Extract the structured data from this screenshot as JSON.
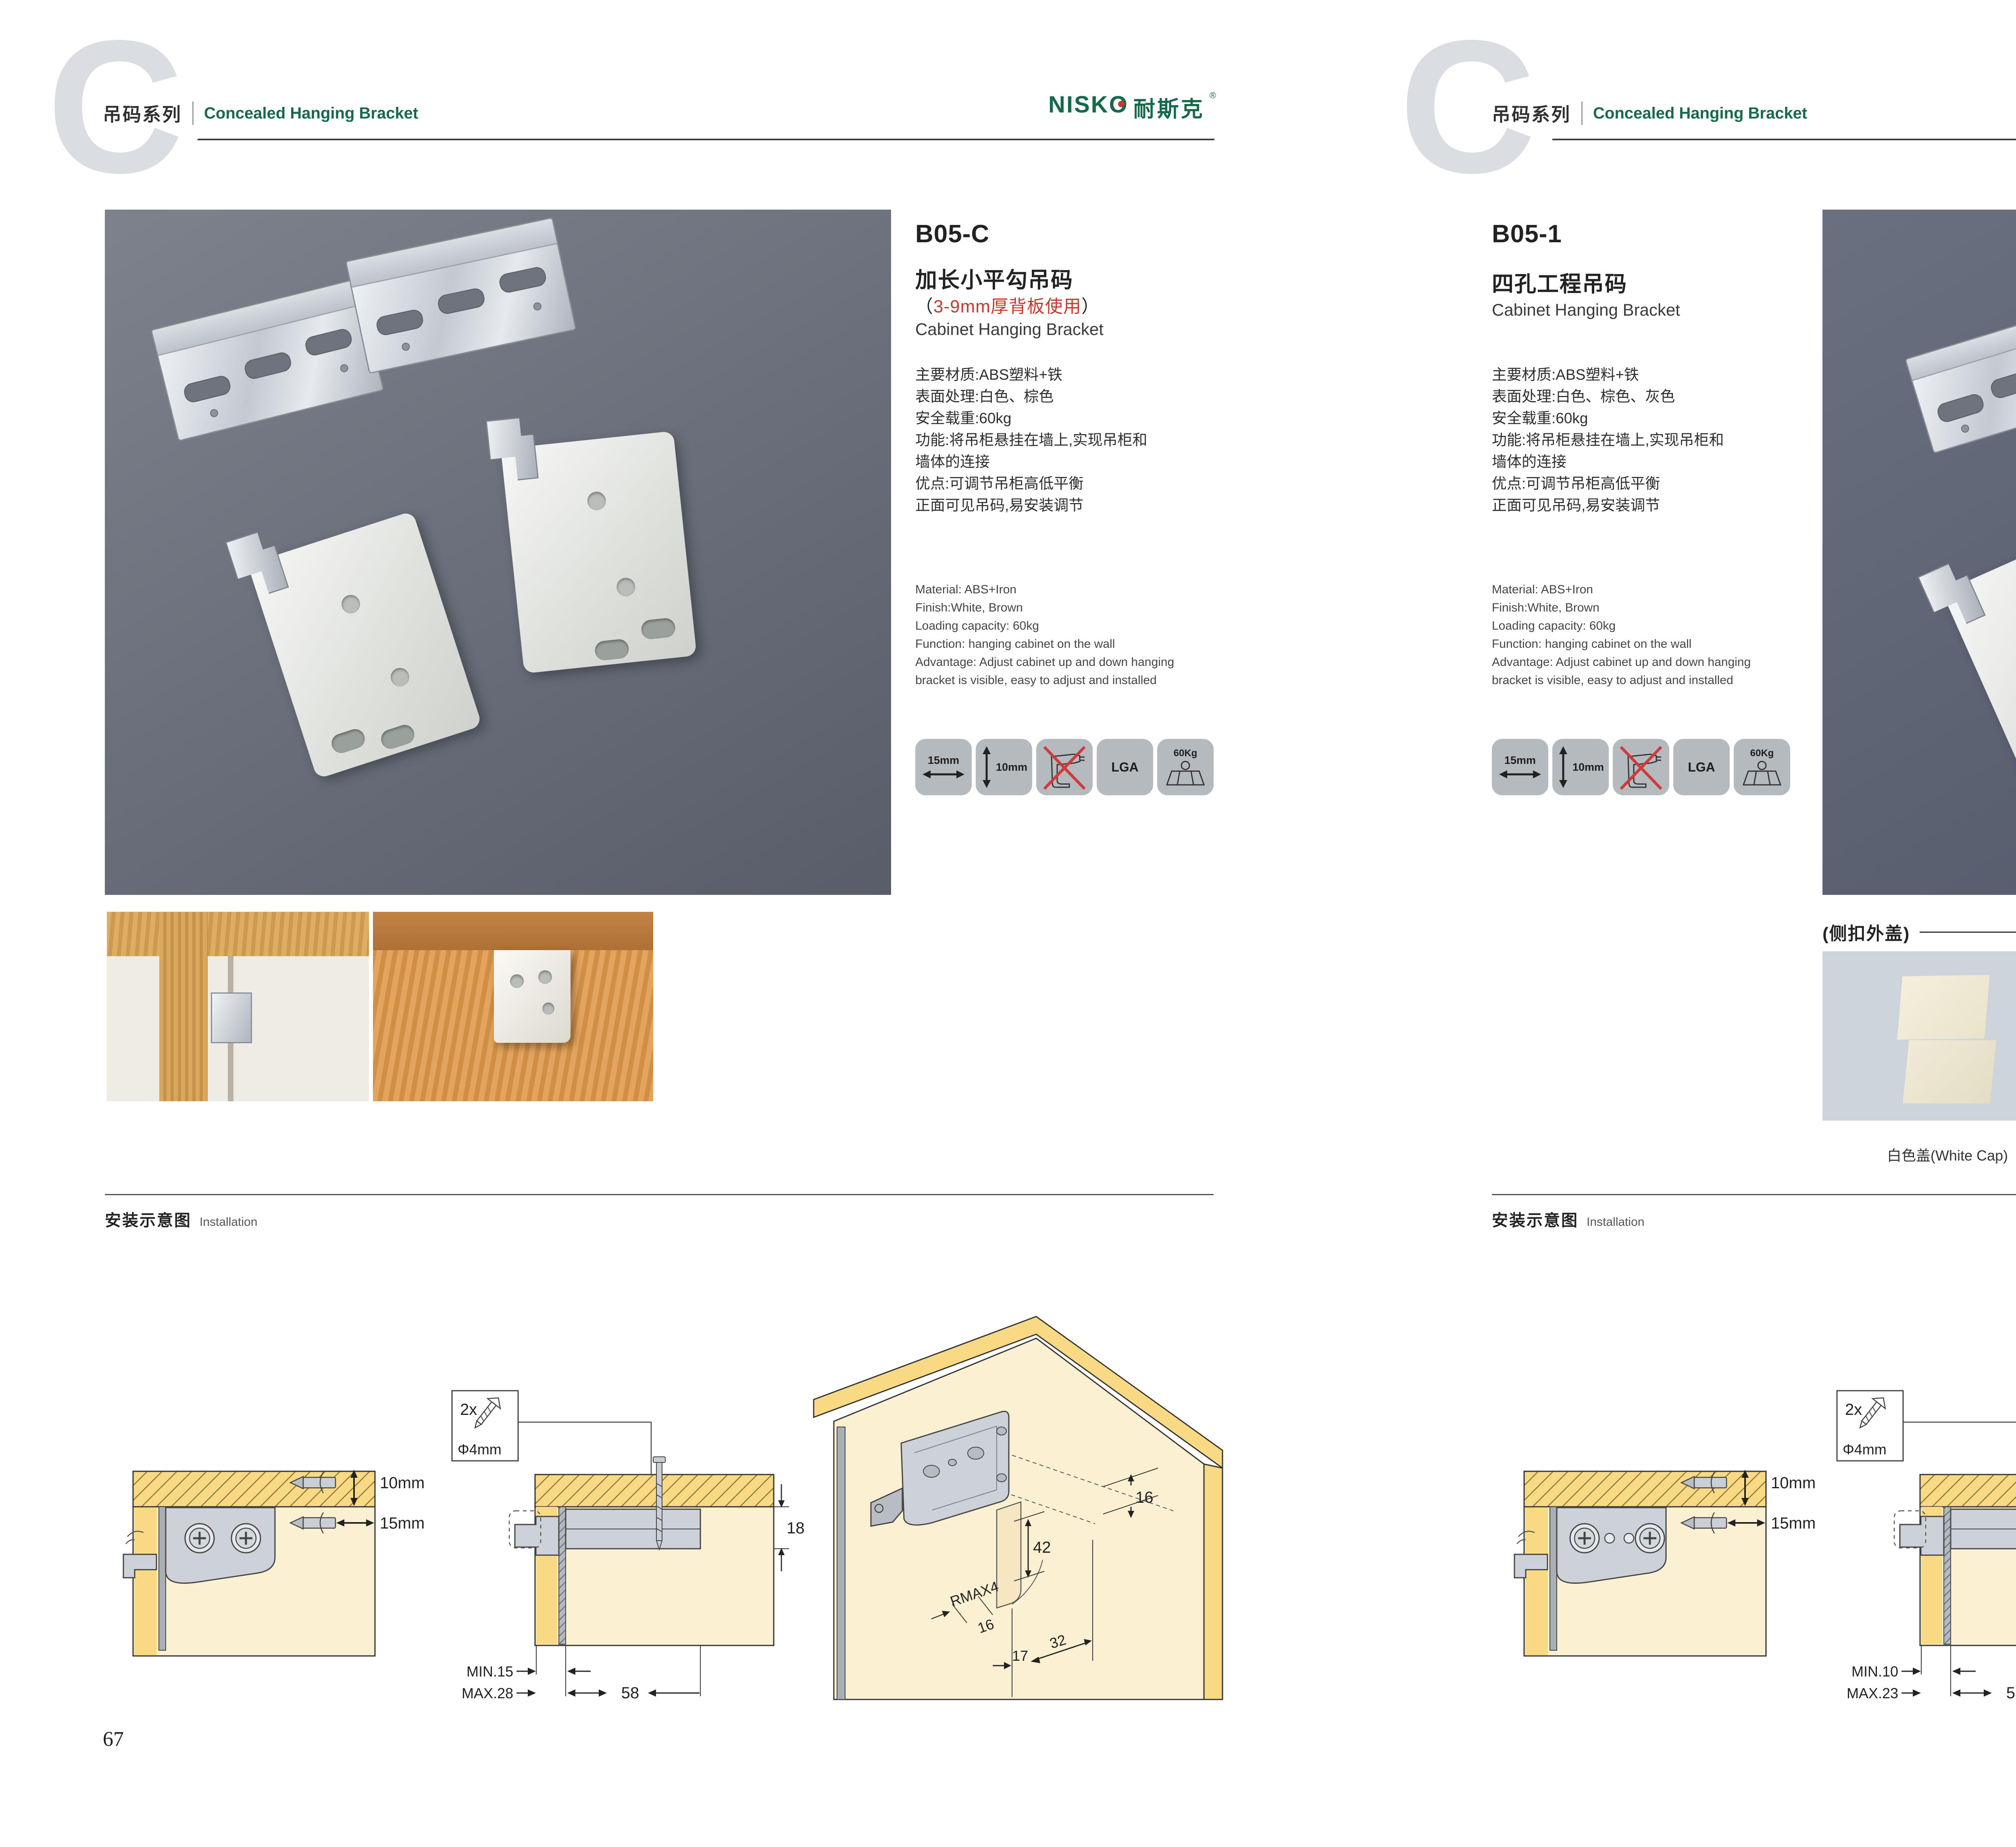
{
  "brand": {
    "logo_text": "NISKO",
    "logo_cn": "耐斯克",
    "reg": "®"
  },
  "colors": {
    "brand_green": "#17694b",
    "accent_red": "#c23a2e",
    "wood_yellow": "#f8da85",
    "panel_cream": "#fcf0d3",
    "photo_bg_left": "#6b7080",
    "photo_bg_right": "#5a6072"
  },
  "pages": [
    {
      "page_no": "67",
      "header": {
        "watermark": "C",
        "series": "吊码系列",
        "subtitle": "Concealed Hanging Bracket"
      },
      "product": {
        "code": "B05-C",
        "name_cn": "加长小平勾吊码",
        "note_open": "（",
        "note_text": "3-9mm厚背板使用",
        "note_close": "）",
        "name_en": "Cabinet Hanging Bracket",
        "specs_cn": [
          "主要材质:ABS塑料+铁",
          "表面处理:白色、棕色",
          "安全载重:60kg",
          "功能:将吊柜悬挂在墙上,实现吊柜和",
          "墙体的连接",
          "优点:可调节吊柜高低平衡",
          "正面可见吊码,易安装调节"
        ],
        "specs_en": [
          "Material: ABS+Iron",
          "Finish:White, Brown",
          "Loading capacity: 60kg",
          "Function: hanging cabinet on the wall",
          "Advantage: Adjust cabinet up and down hanging",
          "bracket is visible, easy to adjust and installed"
        ]
      },
      "icons": {
        "width_label": "15mm",
        "height_label": "10mm",
        "cert_label": "LGA",
        "load_label": "60Kg"
      },
      "installation": {
        "title_cn": "安装示意图",
        "title_en": "Installation"
      },
      "diagram1": {
        "top_label": "10mm",
        "bottom_label": "15mm"
      },
      "diagram2": {
        "screw_qty": "2x",
        "screw_dia": "Φ4mm",
        "height": "18",
        "min": "MIN.15",
        "max": "MAX.28",
        "width": "58"
      },
      "diagram3": {
        "top": "16",
        "mid": "42",
        "radius": "RMAX4",
        "b1": "16",
        "b2": "17",
        "b3": "32"
      }
    },
    {
      "page_no": "68",
      "header": {
        "watermark": "C",
        "series": "吊码系列",
        "subtitle": "Concealed Hanging Bracket"
      },
      "product": {
        "code": "B05-1",
        "name_cn": "四孔工程吊码",
        "name_en": "Cabinet Hanging Bracket",
        "specs_cn": [
          "主要材质:ABS塑料+铁",
          "表面处理:白色、棕色、灰色",
          "安全载重:60kg",
          "功能:将吊柜悬挂在墙上,实现吊柜和",
          "墙体的连接",
          "优点:可调节吊柜高低平衡",
          "正面可见吊码,易安装调节"
        ],
        "specs_en": [
          "Material: ABS+Iron",
          "Finish:White, Brown",
          "Loading capacity: 60kg",
          "Function: hanging cabinet on the wall",
          "Advantage: Adjust cabinet up and down hanging",
          "bracket is visible, easy to adjust and installed"
        ]
      },
      "caps": {
        "label": "(侧扣外盖)",
        "items": [
          "白色盖(White Cap)",
          "灰色盖(Gray Cap)",
          "棕色盖(Silver Cap)"
        ]
      },
      "icons": {
        "width_label": "15mm",
        "height_label": "10mm",
        "cert_label": "LGA",
        "load_label": "60Kg"
      },
      "installation": {
        "title_cn": "安装示意图",
        "title_en": "Installation"
      },
      "diagram1": {
        "top_label": "10mm",
        "bottom_label": "15mm"
      },
      "diagram2": {
        "screw_qty": "2x",
        "screw_dia": "Φ4mm",
        "height": "18",
        "min": "MIN.10",
        "max": "MAX.23",
        "width": "58"
      },
      "diagram3": {
        "top": "16",
        "mid": "42",
        "radius": "RMAX4",
        "b1": "16",
        "b2": "17",
        "b3": "32"
      }
    }
  ]
}
